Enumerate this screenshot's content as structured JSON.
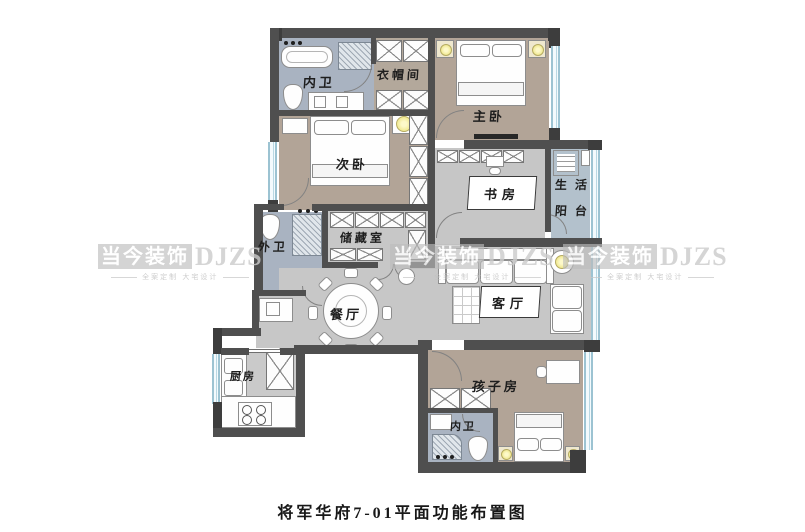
{
  "caption": "将军华府7-01平面功能布置图",
  "watermark": {
    "brand_cn": "当今装饰",
    "brand_en": "DJZS",
    "tagline": "全案定制 大宅设计"
  },
  "rooms": {
    "bath_master": "内卫",
    "cloakroom": "衣帽间",
    "master_bedroom": "主卧",
    "second_bedroom": "次卧",
    "study": "书房",
    "balcony_top": "生活",
    "balcony_bottom": "阳台",
    "bath_guest": "外卫",
    "storage": "储藏室",
    "dining": "餐厅",
    "living": "客厅",
    "kitchen": "厨房",
    "kids_room": "孩子房",
    "bath_kids": "内卫"
  },
  "colors": {
    "wall": "#4f4f4f",
    "wood_floor": "#b2a497",
    "bath_floor": "#a9b3c1",
    "neutral_floor": "#c7c7c7",
    "balcony_floor": "#b3c1cc",
    "window_frame": "#9cc3d2",
    "lamp": "#f2eb9e"
  }
}
